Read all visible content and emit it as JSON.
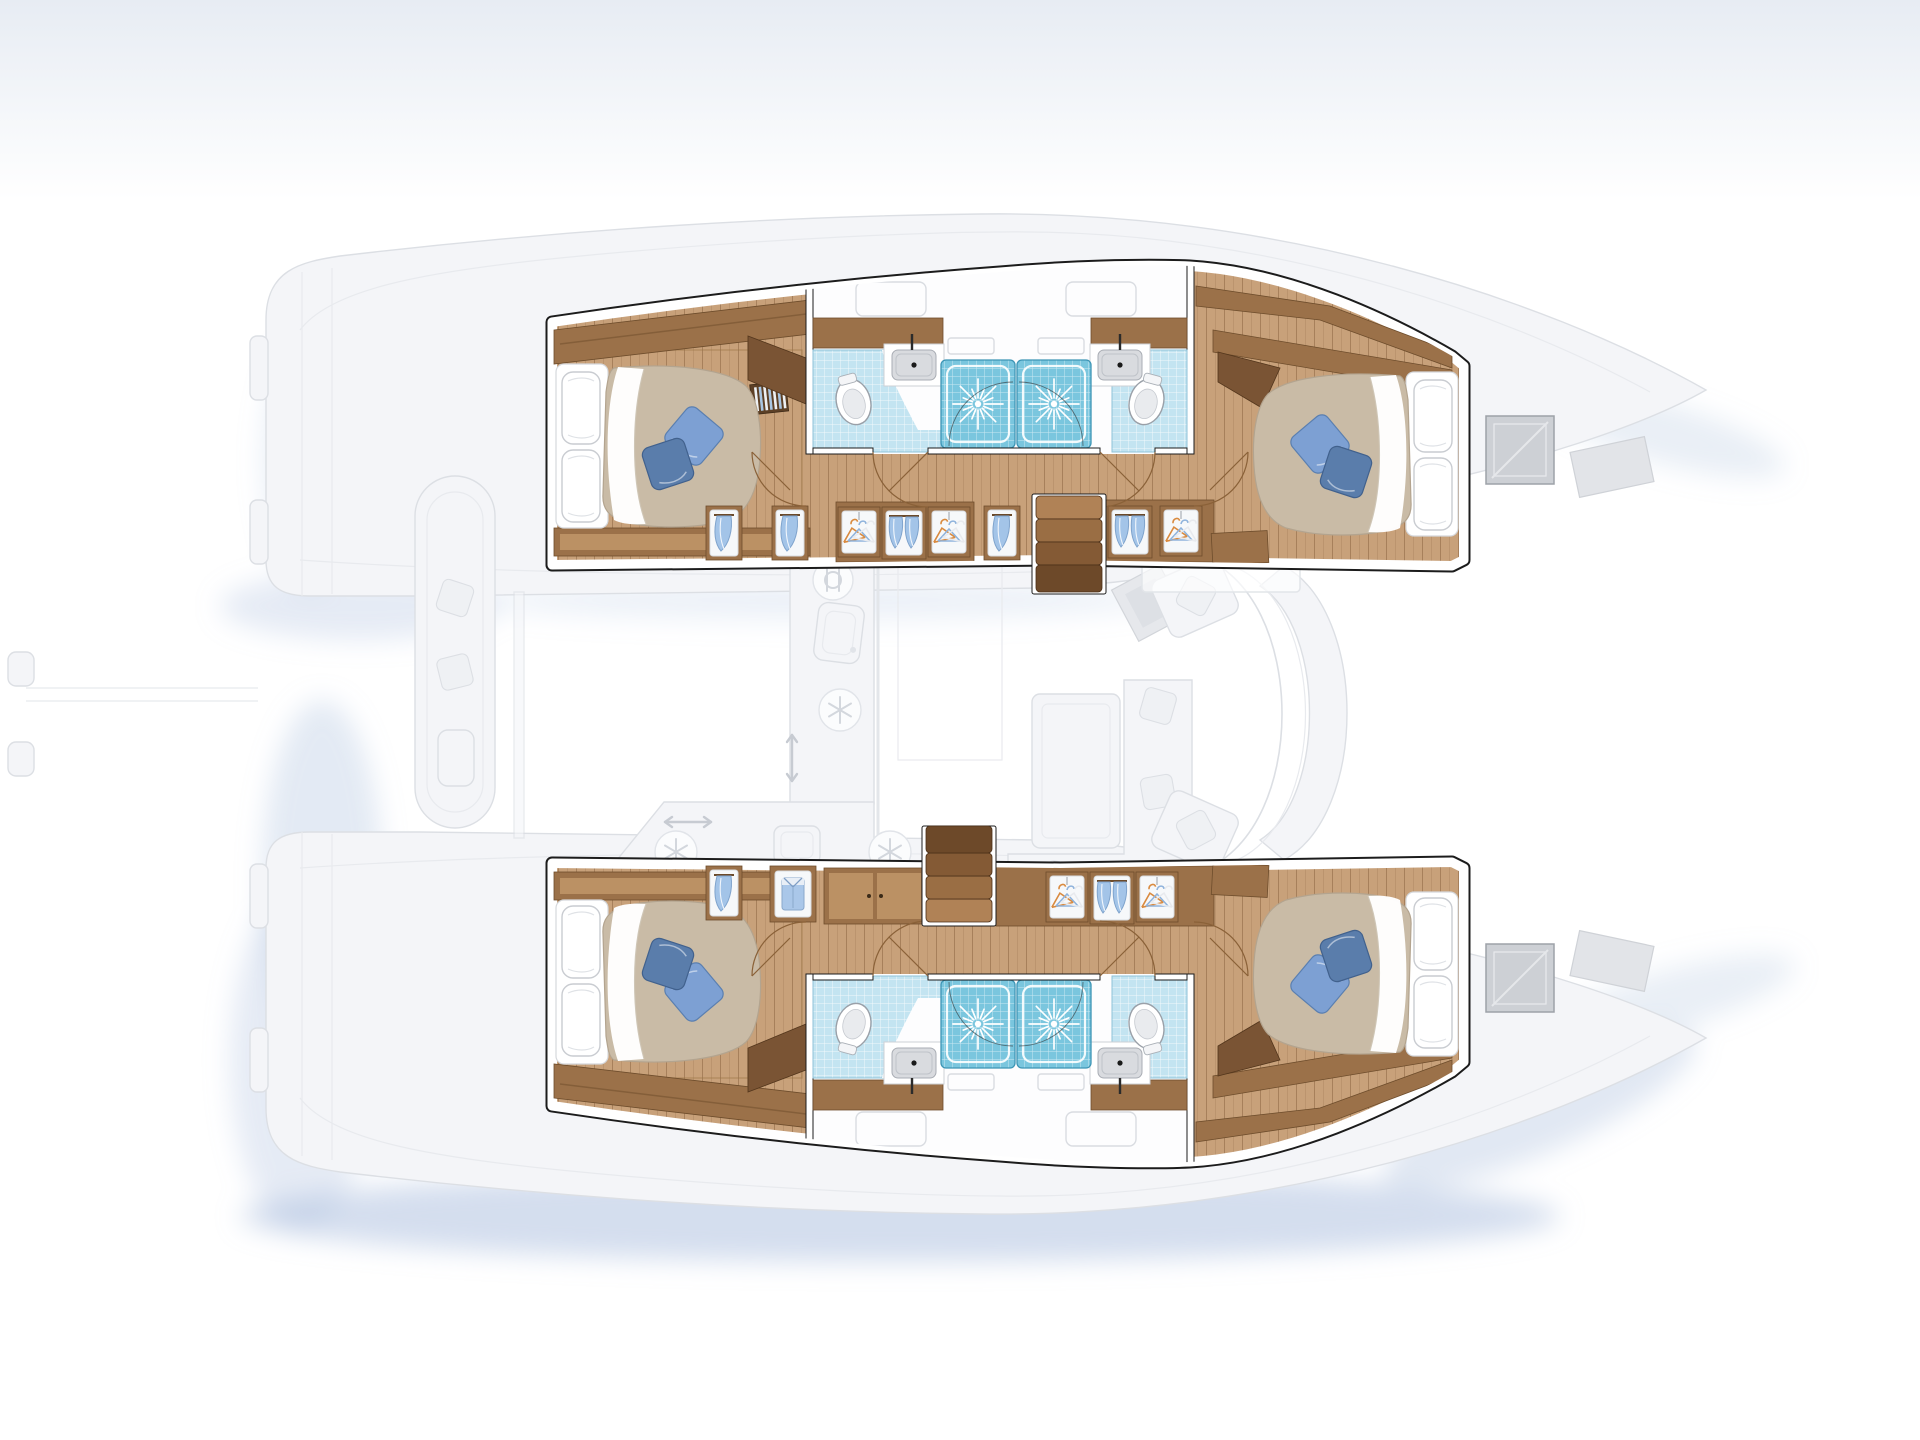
{
  "diagram": {
    "type": "floorplan",
    "subject": "catamaran sailing yacht - 4 cabin / 4 bathroom accommodation layout",
    "view": "overhead deck plan, bows pointing right, hull interiors highlighted, saloon and decks faded",
    "port_hull": {
      "position": "top",
      "rooms": [
        "aft double cabin",
        "aft bathroom (toilet + washbasin)",
        "two central shower stalls",
        "forward bathroom (toilet + washbasin)",
        "forward double cabin"
      ],
      "storage_niches": [
        "linen niche",
        "linen niche",
        "hanging wardrobe",
        "twin hanging towels",
        "hanging wardrobe",
        "linen niche",
        "twin hanging towels",
        "hanging wardrobe"
      ],
      "stairs": "companionway down from saloon",
      "vent_grilles": 2
    },
    "starboard_hull": {
      "position": "bottom",
      "rooms": [
        "aft double cabin",
        "aft bathroom (toilet + washbasin)",
        "two central shower stalls",
        "forward bathroom (toilet + washbasin)",
        "forward double cabin"
      ],
      "storage_niches": [
        "linen niche",
        "folded shirt niche",
        "double-door locker",
        "hanging wardrobe",
        "twin hanging towels",
        "hanging wardrobe"
      ],
      "stairs": "companionway up to saloon",
      "vent_grilles": 2
    },
    "saloon_faded": [
      "galley counter",
      "galley sink",
      "fridge icon x3",
      "cutlery icon",
      "dining table",
      "L-shaped sofa with cushions",
      "nav seat",
      "curved settee",
      "sliding-door arrows",
      "skylight"
    ],
    "deck_faded": [
      "aft cockpit bench with cushions",
      "stern swim platforms",
      "side decks",
      "foredeck seats",
      "bow deck hatches",
      "bow windows",
      "dock lines"
    ],
    "totals": {
      "double_beds": 4,
      "decor_pillows_per_bed": 2,
      "toilets": 4,
      "washbasins": 4,
      "shower_stalls": 4,
      "companionways": 2
    }
  },
  "colors": {
    "floor_wood": "#c8a17a",
    "wood_mid": "#9b7149",
    "wood_dark": "#7a5434",
    "wood_light": "#bb9164",
    "bed_duvet": "#c9bba6",
    "tile_light": "#c3e4f1",
    "tile_dark": "#7ac6de",
    "pillow_blue_light": "#7da0d3",
    "pillow_blue_dark": "#5a7dab",
    "shirt_blue": "#aac7e9",
    "wall_line": "#1c1c1c",
    "faded_fill": "#f4f5f8",
    "faded_line": "#dcdfe4",
    "shadow_blue": "#a9bedd",
    "grille_wood": "#5d4026",
    "paper": "#ffffff"
  }
}
